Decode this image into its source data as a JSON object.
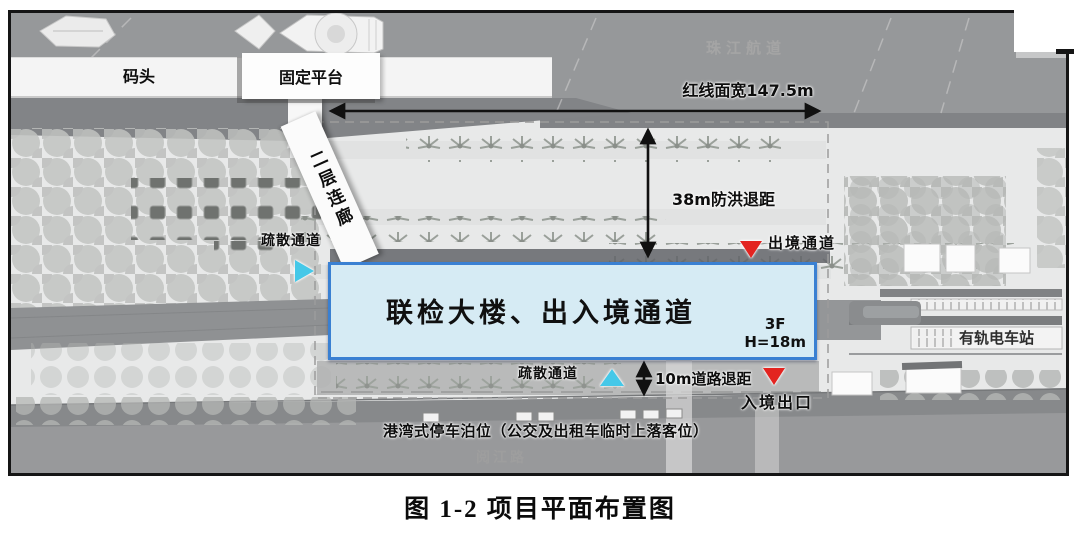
{
  "caption": "图 1-2 项目平面布置图",
  "labels": {
    "dock": "码头",
    "fixed_platform": "固定平台",
    "waterway": "珠江航道",
    "red_line_width": "红线面宽147.5m",
    "corridor": "二层连廊",
    "evacuation_left": "疏散通道",
    "flood_setback": "38m防洪退距",
    "exit_channel": "出境通道",
    "main_building": "联检大楼、出入境通道",
    "floors": "3F",
    "height": "H=18m",
    "evacuation_bottom": "疏散通道",
    "road_setback": "10m道路退距",
    "entry_exit": "入境出口",
    "tram_station": "有轨电车站",
    "bus_bay": "港湾式停车泊位（公交及出租车临时上落客位）",
    "road_name": "阅江路"
  },
  "icons": {
    "exit_channel_marker": "red-triangle-down",
    "entry_exit_marker": "red-triangle-down",
    "evacuation_left_marker": "cyan-triangle-right",
    "evacuation_bottom_marker": "cyan-triangle-up",
    "red_line_arrow": "double-headed-horizontal-arrow",
    "flood_setback_arrow": "double-headed-vertical-arrow",
    "road_setback_arrow": "double-headed-vertical-arrow"
  },
  "colors": {
    "building_fill": "#d6ebf4",
    "building_border": "#3a80d2",
    "marker_red": "#e32420",
    "marker_cyan": "#45c8e8",
    "water_gray": "#96989a",
    "annotation": "#0d0d0d",
    "muted_label": "#a5a5a5"
  }
}
